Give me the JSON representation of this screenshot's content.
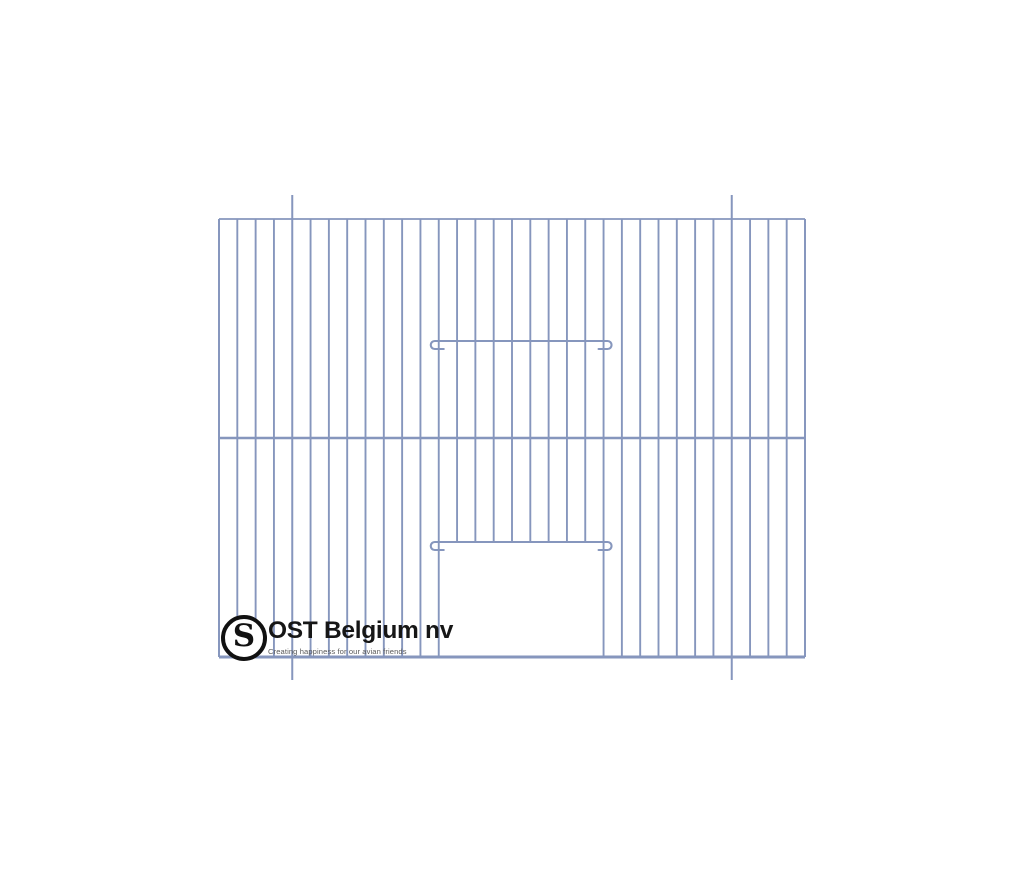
{
  "page": {
    "background_color": "#ffffff",
    "width": 1024,
    "height": 878
  },
  "drawing": {
    "kind": "cage-front-panel-wire-drawing",
    "wire_color": "#8696bd",
    "frame": {
      "left": 219,
      "top": 219,
      "right": 805,
      "bottom": 657
    },
    "vertical_bars": {
      "line_count": 33,
      "gap_count": 32
    },
    "middle_bar_y": 438,
    "guide_bars": {
      "indices": [
        4,
        28
      ],
      "top": 195,
      "bottom": 680
    },
    "door_opening": {
      "left_bar_index": 12,
      "right_bar_index": 21,
      "top": 542
    },
    "hook_rods": {
      "ys": [
        341,
        542
      ],
      "curl_radius": 4,
      "tail_length": 9,
      "overhang": 4
    },
    "stroke_widths": {
      "bar": 1.9,
      "frame": 1.8,
      "middle_bar": 2.6,
      "bottom_frame": 3,
      "hook_rod": 2.1,
      "guide": 2
    }
  },
  "logo": {
    "monogram": "S",
    "company_name": "OST Belgium nv",
    "tagline": "Creating happiness for our avian friends",
    "ring_color": "#111111",
    "name_color": "#161616",
    "tagline_color": "#5a5a5a"
  }
}
